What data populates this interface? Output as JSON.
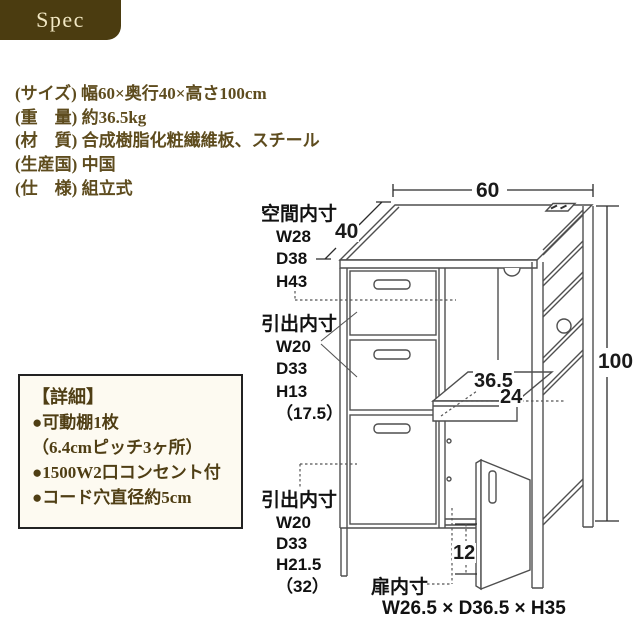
{
  "header": {
    "title": "Spec"
  },
  "colors": {
    "brand_brown": "#4b3c10",
    "header_text": "#f2e8c4",
    "spec_text": "#5e4c1e",
    "detail_text": "#4f3e14",
    "detail_bg": "#fdfaf1",
    "diagram_line": "#4f4f4f",
    "dim_text": "#1a1a1a"
  },
  "specs": {
    "items": [
      "(サイズ) 幅60×奥行40×高さ100cm",
      "(重　量) 約36.5kg",
      "(材　質) 合成樹脂化粧繊維板、スチール",
      "(生産国) 中国",
      "(仕　様) 組立式"
    ]
  },
  "details": {
    "title": "【詳細】",
    "items": [
      "●可動棚1枚",
      "（6.4cmピッチ3ヶ所）",
      "●1500W2口コンセント付",
      "●コード穴直径約5cm"
    ]
  },
  "diagram": {
    "dimensions": {
      "width": "60",
      "depth": "40",
      "height": "100",
      "shelf_depth": "36.5",
      "shelf_width": "24",
      "bottom_clearance": "12"
    },
    "labels": {
      "space_inner": {
        "title": "空間内寸",
        "w": "W28",
        "d": "D38",
        "h": "H43"
      },
      "drawer_upper": {
        "title": "引出内寸",
        "w": "W20",
        "d": "D33",
        "h": "H13",
        "h_alt": "（17.5）"
      },
      "drawer_lower": {
        "title": "引出内寸",
        "w": "W20",
        "d": "D33",
        "h": "H21.5",
        "h_alt": "（32）"
      },
      "door_inner": {
        "title": "扉内寸",
        "size": "W26.5 × D36.5 × H35"
      }
    }
  }
}
